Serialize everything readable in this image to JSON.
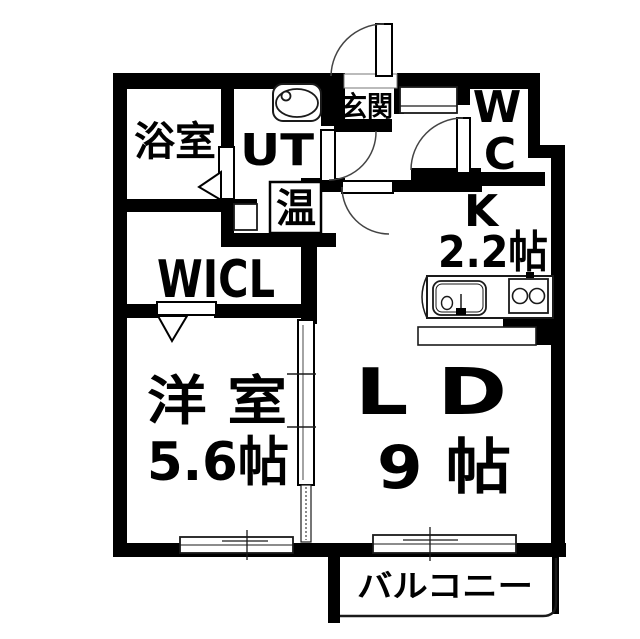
{
  "plan": {
    "type": "apartment-floorplan",
    "rooms": {
      "bathroom": "浴室",
      "utility": "UT",
      "water_heater": "温",
      "entrance": "玄関",
      "toilet_line1": "W",
      "toilet_line2": "C",
      "kitchen": "K",
      "kitchen_size": "2.2帖",
      "closet": "WICL",
      "western_room": "洋 室",
      "western_room_size": "5.6帖",
      "living_dining": "L D",
      "living_dining_size": "9 帖",
      "balcony": "バルコニー"
    },
    "colors": {
      "wall": "#000000",
      "background": "#ffffff",
      "thin_line": "#1a1a1a"
    }
  }
}
